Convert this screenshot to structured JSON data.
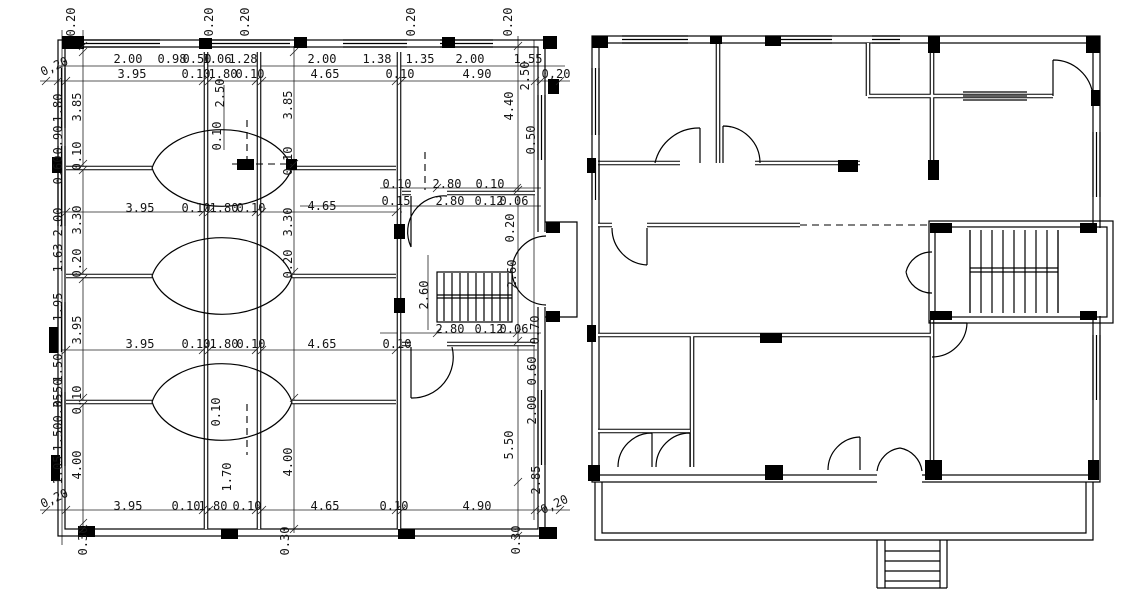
{
  "drawing": {
    "paper_color": "#ffffff",
    "ink_color": "#000000",
    "left_plan": {
      "id": "dimensioned-plan",
      "dim_labels": [
        {
          "t": "0,20",
          "x": 56,
          "y": 70,
          "r": -25
        },
        {
          "t": "2.00",
          "x": 128,
          "y": 63,
          "r": 0
        },
        {
          "t": "0.98",
          "x": 172,
          "y": 63,
          "r": 0
        },
        {
          "t": "0.50",
          "x": 197,
          "y": 63,
          "r": 0
        },
        {
          "t": "1.06",
          "x": 217,
          "y": 63,
          "r": 0
        },
        {
          "t": "1.28",
          "x": 243,
          "y": 63,
          "r": 0
        },
        {
          "t": "2.00",
          "x": 322,
          "y": 63,
          "r": 0
        },
        {
          "t": "1.38",
          "x": 377,
          "y": 63,
          "r": 0
        },
        {
          "t": "1.35",
          "x": 420,
          "y": 63,
          "r": 0
        },
        {
          "t": "2.00",
          "x": 470,
          "y": 63,
          "r": 0
        },
        {
          "t": "1.55",
          "x": 528,
          "y": 63,
          "r": 0
        },
        {
          "t": "3.95",
          "x": 132,
          "y": 78,
          "r": 0
        },
        {
          "t": "0.10",
          "x": 196,
          "y": 78,
          "r": 0
        },
        {
          "t": "1.80",
          "x": 223,
          "y": 78,
          "r": 0
        },
        {
          "t": "0.10",
          "x": 250,
          "y": 78,
          "r": 0
        },
        {
          "t": "4.65",
          "x": 325,
          "y": 78,
          "r": 0
        },
        {
          "t": "0.10",
          "x": 400,
          "y": 78,
          "r": 0
        },
        {
          "t": "4.90",
          "x": 477,
          "y": 78,
          "r": 0
        },
        {
          "t": "0,20",
          "x": 556,
          "y": 78,
          "r": 0
        },
        {
          "t": "0.20",
          "x": 75,
          "y": 22,
          "r": -90
        },
        {
          "t": "0.20",
          "x": 213,
          "y": 22,
          "r": -90
        },
        {
          "t": "0.20",
          "x": 249,
          "y": 22,
          "r": -90
        },
        {
          "t": "0.20",
          "x": 415,
          "y": 22,
          "r": -90
        },
        {
          "t": "0.20",
          "x": 512,
          "y": 22,
          "r": -90
        },
        {
          "t": "2.50",
          "x": 224,
          "y": 93,
          "r": -90
        },
        {
          "t": "0.10",
          "x": 221,
          "y": 136,
          "r": -90
        },
        {
          "t": "3.95",
          "x": 140,
          "y": 212,
          "r": 0
        },
        {
          "t": "0.10",
          "x": 196,
          "y": 212,
          "r": 0
        },
        {
          "t": "1.80",
          "x": 224,
          "y": 212,
          "r": 0
        },
        {
          "t": "0.10",
          "x": 251,
          "y": 212,
          "r": 0
        },
        {
          "t": "4.65",
          "x": 322,
          "y": 210,
          "r": 0
        },
        {
          "t": "0.10",
          "x": 397,
          "y": 188,
          "r": 0
        },
        {
          "t": "2.80",
          "x": 447,
          "y": 188,
          "r": 0
        },
        {
          "t": "0.10",
          "x": 490,
          "y": 188,
          "r": 0
        },
        {
          "t": "0.15",
          "x": 396,
          "y": 205,
          "r": 0
        },
        {
          "t": "2.80",
          "x": 450,
          "y": 205,
          "r": 0
        },
        {
          "t": "0.12",
          "x": 489,
          "y": 205,
          "r": 0
        },
        {
          "t": "0.06",
          "x": 514,
          "y": 205,
          "r": 0
        },
        {
          "t": "2.80",
          "x": 450,
          "y": 333,
          "r": 0
        },
        {
          "t": "0.12",
          "x": 489,
          "y": 333,
          "r": 0
        },
        {
          "t": "0.06",
          "x": 514,
          "y": 333,
          "r": 0
        },
        {
          "t": "3.95",
          "x": 140,
          "y": 348,
          "r": 0
        },
        {
          "t": "0.10",
          "x": 196,
          "y": 348,
          "r": 0
        },
        {
          "t": "1.80",
          "x": 224,
          "y": 348,
          "r": 0
        },
        {
          "t": "0.10",
          "x": 251,
          "y": 348,
          "r": 0
        },
        {
          "t": "4.65",
          "x": 322,
          "y": 348,
          "r": 0
        },
        {
          "t": "0.10",
          "x": 397,
          "y": 348,
          "r": 0
        },
        {
          "t": "0,20",
          "x": 56,
          "y": 502,
          "r": -25
        },
        {
          "t": "3.95",
          "x": 128,
          "y": 510,
          "r": 0
        },
        {
          "t": "0.10",
          "x": 186,
          "y": 510,
          "r": 0
        },
        {
          "t": "1.80",
          "x": 213,
          "y": 510,
          "r": 0
        },
        {
          "t": "0.10",
          "x": 247,
          "y": 510,
          "r": 0
        },
        {
          "t": "4.65",
          "x": 325,
          "y": 510,
          "r": 0
        },
        {
          "t": "0.10",
          "x": 394,
          "y": 510,
          "r": 0
        },
        {
          "t": "4.90",
          "x": 477,
          "y": 510,
          "r": 0
        },
        {
          "t": "0,20",
          "x": 556,
          "y": 508,
          "r": -25
        },
        {
          "t": "0.30",
          "x": 87,
          "y": 541,
          "r": -90
        },
        {
          "t": "0.30",
          "x": 289,
          "y": 541,
          "r": -90
        },
        {
          "t": "0.30",
          "x": 520,
          "y": 540,
          "r": -90
        },
        {
          "t": "1.80",
          "x": 62,
          "y": 108,
          "r": -90
        },
        {
          "t": "0.90",
          "x": 62,
          "y": 140,
          "r": -90
        },
        {
          "t": "0.60",
          "x": 62,
          "y": 170,
          "r": -90
        },
        {
          "t": "2.00",
          "x": 62,
          "y": 222,
          "r": -90
        },
        {
          "t": "1.63",
          "x": 62,
          "y": 258,
          "r": -90
        },
        {
          "t": "1.95",
          "x": 62,
          "y": 307,
          "r": -90
        },
        {
          "t": "1.50",
          "x": 62,
          "y": 368,
          "r": -90
        },
        {
          "t": "0.50",
          "x": 62,
          "y": 393,
          "r": -90
        },
        {
          "t": "0.35",
          "x": 62,
          "y": 408,
          "r": -90
        },
        {
          "t": "1.50",
          "x": 62,
          "y": 437,
          "r": -90
        },
        {
          "t": "1.05",
          "x": 62,
          "y": 470,
          "r": -90
        },
        {
          "t": "3.85",
          "x": 81,
          "y": 107,
          "r": -90
        },
        {
          "t": "0.10",
          "x": 81,
          "y": 156,
          "r": -90
        },
        {
          "t": "3.30",
          "x": 81,
          "y": 220,
          "r": -90
        },
        {
          "t": "0.20",
          "x": 81,
          "y": 263,
          "r": -90
        },
        {
          "t": "3.95",
          "x": 81,
          "y": 330,
          "r": -90
        },
        {
          "t": "0.10",
          "x": 81,
          "y": 400,
          "r": -90
        },
        {
          "t": "4.00",
          "x": 81,
          "y": 465,
          "r": -90
        },
        {
          "t": "3.85",
          "x": 292,
          "y": 105,
          "r": -90
        },
        {
          "t": "0.10",
          "x": 292,
          "y": 161,
          "r": -90
        },
        {
          "t": "3.30",
          "x": 292,
          "y": 222,
          "r": -90
        },
        {
          "t": "0.20",
          "x": 292,
          "y": 264,
          "r": -90
        },
        {
          "t": "4.00",
          "x": 292,
          "y": 462,
          "r": -90
        },
        {
          "t": "0.10",
          "x": 220,
          "y": 412,
          "r": -90
        },
        {
          "t": "1.70",
          "x": 231,
          "y": 477,
          "r": -90
        },
        {
          "t": "2.60",
          "x": 428,
          "y": 295,
          "r": -90
        },
        {
          "t": "2.50",
          "x": 529,
          "y": 76,
          "r": -90
        },
        {
          "t": "4.40",
          "x": 513,
          "y": 106,
          "r": -90
        },
        {
          "t": "0.50",
          "x": 535,
          "y": 140,
          "r": -90
        },
        {
          "t": "0.20",
          "x": 514,
          "y": 228,
          "r": -90
        },
        {
          "t": "2.60",
          "x": 516,
          "y": 274,
          "r": -90
        },
        {
          "t": "0.70",
          "x": 539,
          "y": 330,
          "r": -90
        },
        {
          "t": "0.60",
          "x": 536,
          "y": 371,
          "r": -90
        },
        {
          "t": "2.00",
          "x": 536,
          "y": 410,
          "r": -90
        },
        {
          "t": "5.50",
          "x": 513,
          "y": 445,
          "r": -90
        },
        {
          "t": "2.85",
          "x": 540,
          "y": 480,
          "r": -90
        }
      ]
    },
    "right_plan": {
      "id": "plain-plan",
      "dim_labels": []
    }
  }
}
